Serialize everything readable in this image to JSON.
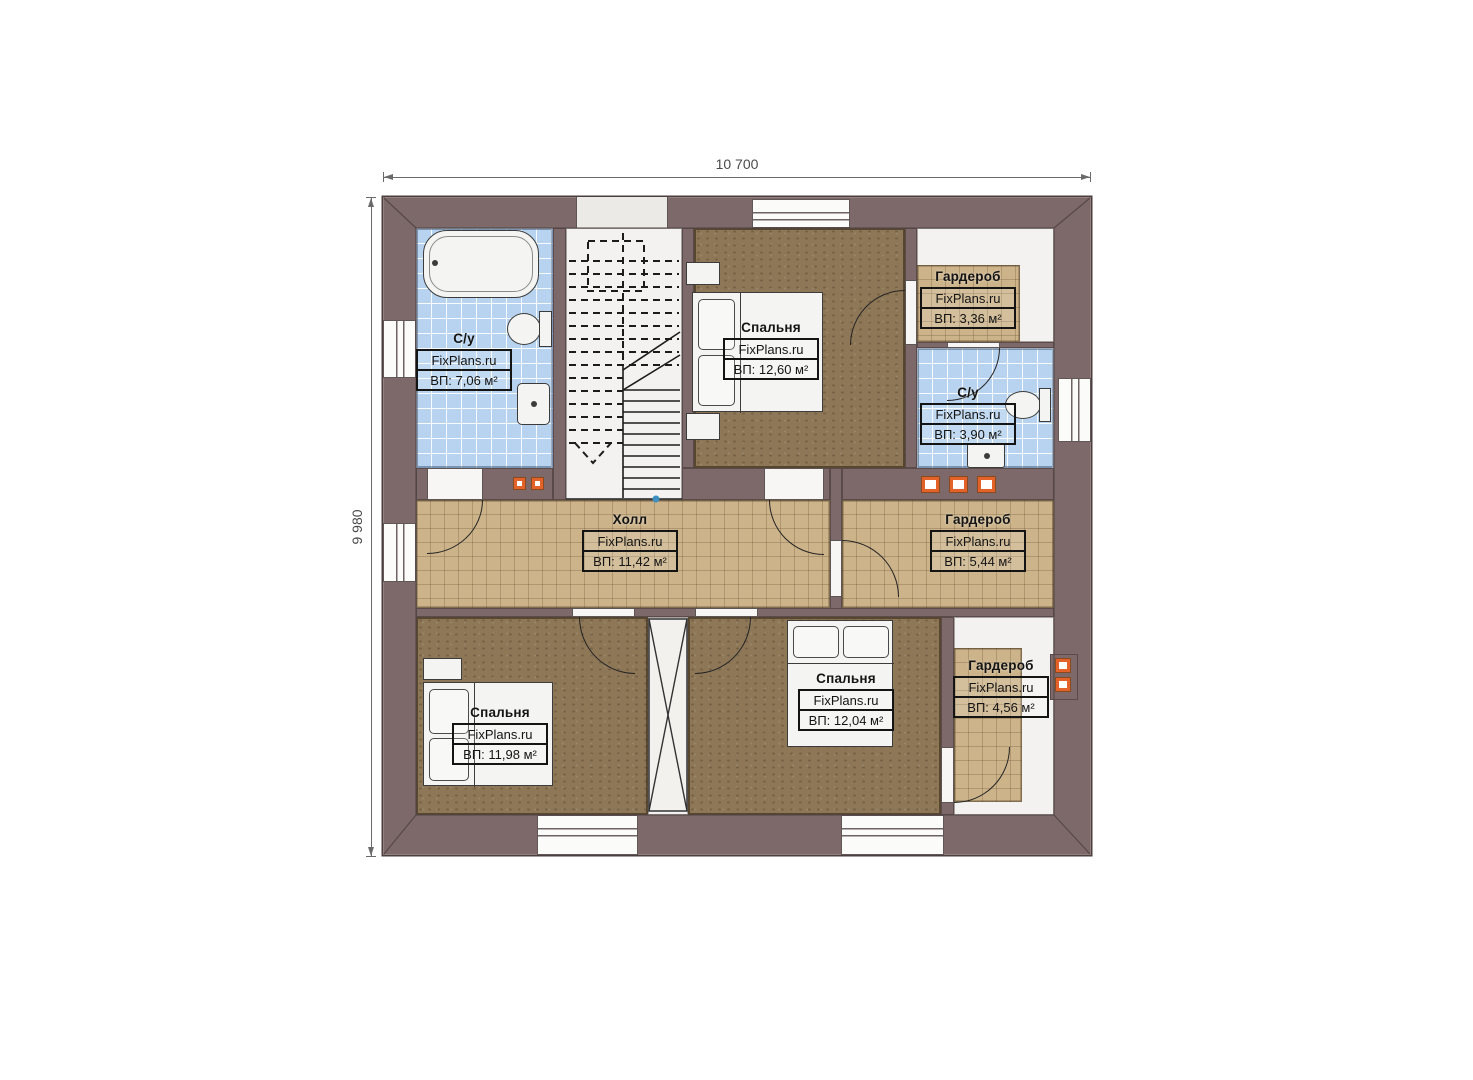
{
  "watermark": "FixPlans.ru",
  "dimensions": {
    "top": "10 700",
    "left": "9 980"
  },
  "rooms": [
    {
      "key": "su-left",
      "name": "С/у",
      "area": "ВП: 7,06 м²"
    },
    {
      "key": "bedroom-top",
      "name": "Спальня",
      "area": "ВП: 12,60 м²"
    },
    {
      "key": "wardrobe-top-right",
      "name": "Гардероб",
      "area": "ВП: 3,36 м²"
    },
    {
      "key": "su-right",
      "name": "С/у",
      "area": "ВП: 3,90 м²"
    },
    {
      "key": "hall",
      "name": "Холл",
      "area": "ВП: 11,42 м²"
    },
    {
      "key": "wardrobe-right",
      "name": "Гардероб",
      "area": "ВП: 5,44 м²"
    },
    {
      "key": "bedroom-bottom-left",
      "name": "Спальня",
      "area": "ВП: 11,98 м²"
    },
    {
      "key": "bedroom-bottom-center",
      "name": "Спальня",
      "area": "ВП: 12,04 м²"
    },
    {
      "key": "wardrobe-bottom-right",
      "name": "Гардероб",
      "area": "ВП: 4,56 м²"
    }
  ],
  "colors": {
    "wall": "#7d6969",
    "tile_blue": "#b7d3ef",
    "tile_tan": "#ccb389",
    "floor_brown": "#8d7757",
    "accent_orange": "#e2622a",
    "line": "#141414"
  }
}
